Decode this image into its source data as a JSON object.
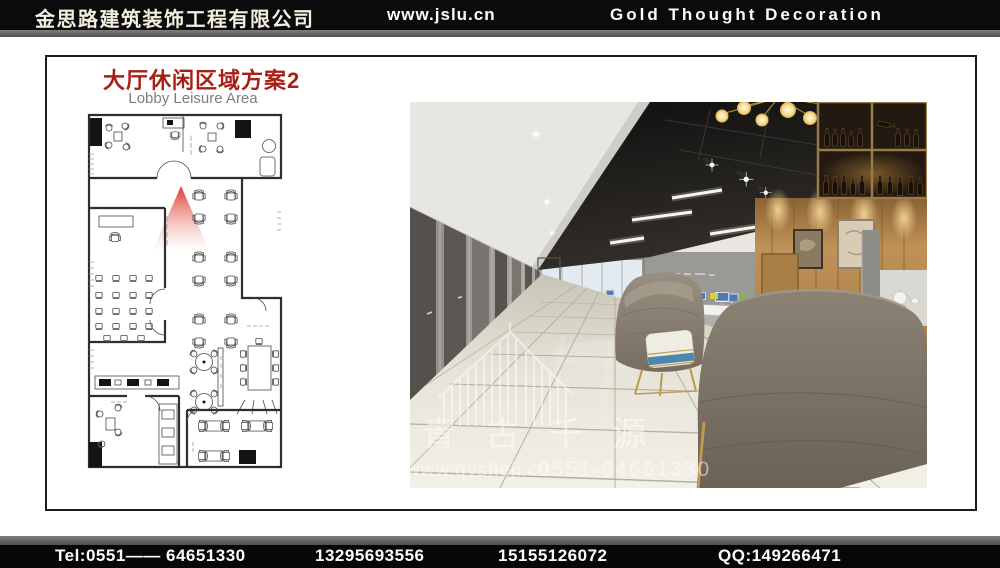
{
  "header": {
    "company_name_cn": "金思路建筑装饰工程有限公司",
    "website": "www.jslu.cn",
    "company_name_en": "Gold  Thought  Decoration"
  },
  "slide": {
    "title_cn": "大厅休闲区域方案2",
    "title_en": "Lobby Leisure Area"
  },
  "floorplan": {
    "description": "lobby-leisure-area-floor-plan",
    "view_cone_color": "#df3126"
  },
  "photo_watermark": {
    "brand_cn": "青 古 千 源",
    "url": "www.qysheji.cn",
    "phone": "0551-64651330"
  },
  "footer": {
    "tel": "Tel:0551—— 64651330",
    "mobile1": "13295693556",
    "mobile2": "15155126072",
    "qq": "QQ:149266471"
  },
  "colors": {
    "header_bg": "#0b0b0b",
    "title_red": "#a82015",
    "cone_red": "#df3126",
    "accent_gold": "#c0984f",
    "footer_bg": "#070707"
  }
}
